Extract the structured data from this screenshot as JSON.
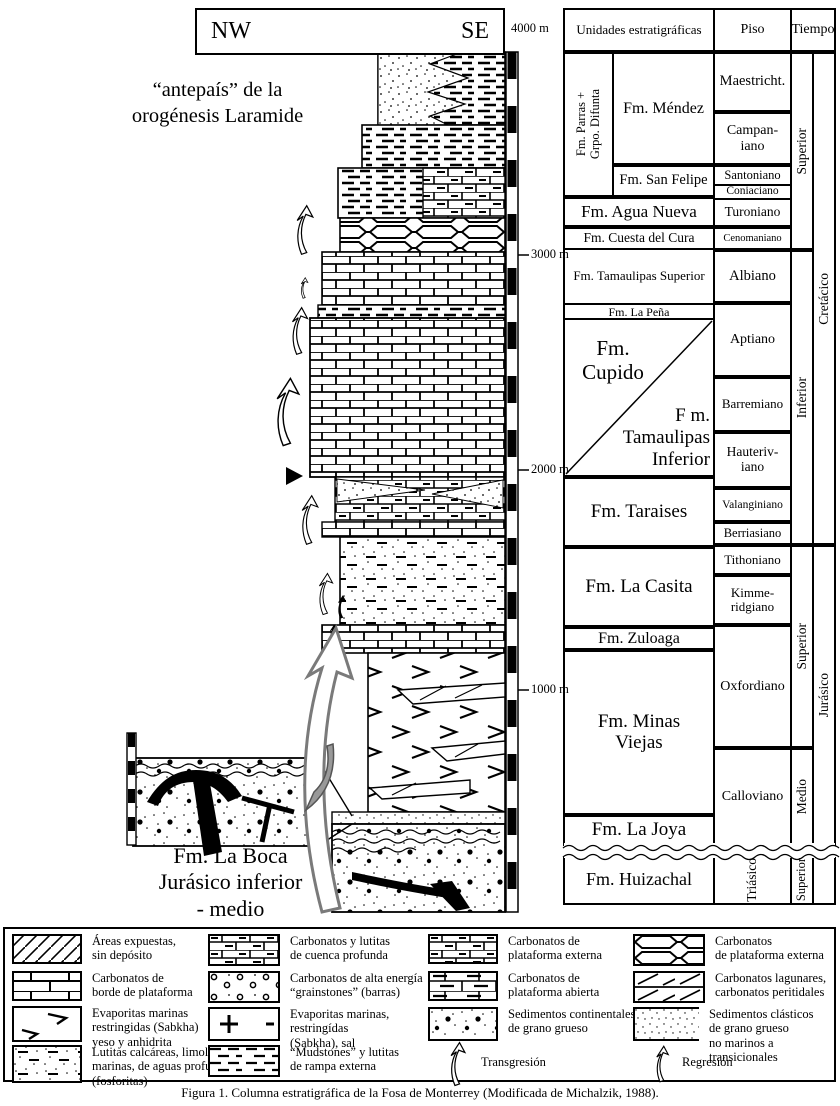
{
  "figure": {
    "section_box": {
      "nw": "NW",
      "se": "SE"
    },
    "scale": {
      "m4000": "4000 m",
      "m3000": "3000 m",
      "m2000": "2000 m",
      "m1000": "1000 m"
    },
    "annotations": {
      "foreland": "“antepaís” de la\norogénesis Laramide",
      "la_boca": "Fm. La Boca\nJurásico inferior\n- medio"
    },
    "table": {
      "header": {
        "unidades": "Unidades estratigráficas",
        "piso": "Piso",
        "tiempo": "Tiempo"
      },
      "formations": {
        "parras": "Fm. Parras +\nGrpo. Difunta",
        "mendez": "Fm. Méndez",
        "san_felipe": "Fm. San Felipe",
        "agua_nueva": "Fm. Agua Nueva",
        "cuesta_del_cura": "Fm. Cuesta del Cura",
        "tamaulipas_superior": "Fm. Tamaulipas Superior",
        "la_pena": "Fm. La Peña",
        "cupido": "Fm.\nCupido",
        "tamaulipas_inferior": "F m.\nTamaulipas\nInferior",
        "taraises": "Fm. Taraises",
        "la_casita": "Fm. La Casita",
        "zuloaga": "Fm. Zuloaga",
        "minas_viejas": "Fm. Minas\nViejas",
        "la_joya": "Fm. La Joya",
        "huizachal": "Fm. Huizachal"
      },
      "stages": {
        "maestricht": "Maestricht.",
        "campaniano": "Campan-\niano",
        "santoniano": "Santoniano",
        "coniaciano": "Coniaciano",
        "turoniano": "Turoniano",
        "cenomaniano": "Cenomaniano",
        "albiano": "Albiano",
        "aptiano": "Aptiano",
        "barremiano": "Barremiano",
        "hauteriviano": "Hauteriv-\niano",
        "valanginiano": "Valanginiano",
        "berriasiano": "Berriasiano",
        "tithoniano": "Tithoniano",
        "kimmeridgiano": "Kimme-\nridgiano",
        "oxfordiano": "Oxfordiano",
        "calloviano": "Calloviano",
        "triasico": "Triásico"
      },
      "epochs": {
        "cretacico_superior": "Superior",
        "cretacico_inferior": "Inferior",
        "jurasico_superior": "Superior",
        "jurasico_medio": "Medio",
        "triasico_superior": "Superior"
      },
      "periods": {
        "cretacico": "Cretácico",
        "jurasico": "Jurásico"
      }
    },
    "legend": {
      "items": [
        {
          "pattern": "diagonal-hatch",
          "label": "Áreas expuestas,\nsin depósito"
        },
        {
          "pattern": "platform-edge-brick",
          "label": "Carbonatos de\nborde de plataforma"
        },
        {
          "pattern": "sabkha-chevrons",
          "label": "Evaporitas marinas\nrestringidas (Sabkha)\nyeso y anhidrita"
        },
        {
          "pattern": "stipple-dash",
          "label": "Lutitas calcáreas, limolitas\nmarinas, de aguas profundas\n(fosforitas)"
        },
        {
          "pattern": "brick-dash",
          "label": "Carbonatos y lutitas\nde cuenca profunda"
        },
        {
          "pattern": "grainstone-circles",
          "label": "Carbonatos de alta energía\n“grainstones” (barras)"
        },
        {
          "pattern": "salt-plus",
          "label": "Evaporitas marinas,\nrestringídas\n(Sabkha), sal"
        },
        {
          "pattern": "mudstone-dashes",
          "label": "“Mudstones” y lutitas\nde rampa externa"
        },
        {
          "pattern": "outer-platform-brick",
          "label": "Carbonatos de\nplataforma externa"
        },
        {
          "pattern": "open-platform-brick",
          "label": "Carbonatos de\nplataforma abierta"
        },
        {
          "pattern": "coarse-continental",
          "label": "Sedimentos continentales\nde grano grueso"
        },
        {
          "pattern": "transgression-arrow",
          "label": "Transgresión"
        },
        {
          "pattern": "nodular-carbonate",
          "label": "Carbonatos\nde plataforma externa"
        },
        {
          "pattern": "lagoon-carbonate",
          "label": "Carbonatos lagunares,\ncarbonatos peritidales"
        },
        {
          "pattern": "fine-stipple",
          "label": "Sedimentos clásticos\nde grano grueso\nno marinos a transicionales"
        },
        {
          "pattern": "regression-arrow",
          "label": "Regresión"
        }
      ]
    },
    "caption": "Figura 1. Columna estratigráfica de la Fosa de Monterrey (Modificada de Michalzik, 1988)."
  }
}
